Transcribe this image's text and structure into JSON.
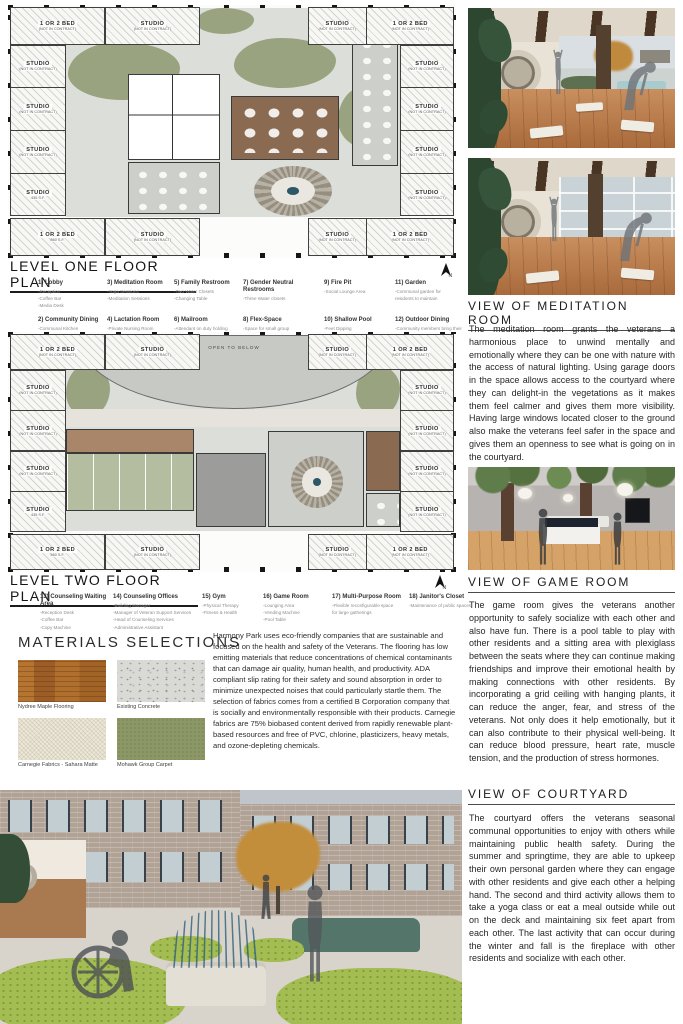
{
  "poster": {
    "north_label": "N",
    "units": {
      "top_left": [
        {
          "t": "1 OR 2 BED",
          "s": "(NOT IN CONTRACT)"
        },
        {
          "t": "STUDIO",
          "s": "(NOT IN CONTRACT)"
        }
      ],
      "top_right": [
        {
          "t": "STUDIO",
          "s": "(NOT IN CONTRACT)"
        },
        {
          "t": "1 OR 2 BED",
          "s": "(NOT IN CONTRACT)"
        }
      ],
      "left_col": [
        {
          "t": "STUDIO",
          "s": "(NOT IN CONTRACT)"
        },
        {
          "t": "STUDIO",
          "s": "(NOT IN CONTRACT)"
        },
        {
          "t": "STUDIO",
          "s": "(NOT IN CONTRACT)"
        },
        {
          "t": "STUDIO",
          "s": "435 S.F."
        }
      ],
      "right_col": [
        {
          "t": "STUDIO",
          "s": "(NOT IN CONTRACT)"
        },
        {
          "t": "STUDIO",
          "s": "(NOT IN CONTRACT)"
        },
        {
          "t": "STUDIO",
          "s": "(NOT IN CONTRACT)"
        },
        {
          "t": "STUDIO",
          "s": "(NOT IN CONTRACT)"
        }
      ],
      "bottom_left": [
        {
          "t": "1 OR 2 BED",
          "s": "860 S.F."
        },
        {
          "t": "STUDIO",
          "s": "(NOT IN CONTRACT)"
        }
      ],
      "bottom_right": [
        {
          "t": "STUDIO",
          "s": "(NOT IN CONTRACT)"
        },
        {
          "t": "1 OR 2 BED",
          "s": "(NOT IN CONTRACT)"
        }
      ]
    },
    "plan_one": {
      "title": "LEVEL ONE FLOOR PLAN",
      "legend": [
        {
          "label": "1) Lobby",
          "details": "-Reception\n-Coffee Bar\n-Media Desk"
        },
        {
          "label": "2) Community Dining",
          "details": "-Communal Kitchen\n-Dining Seating"
        },
        {
          "label": "3) Meditation Room",
          "details": "-Yoga Sessions\n-Meditation Sessions"
        },
        {
          "label": "4) Lactation Room",
          "details": "-Private Nursing Room"
        },
        {
          "label": "5) Family Restroom",
          "details": "-Two Water Closets\n-Changing Table"
        },
        {
          "label": "6) Mailroom",
          "details": "-Attendant on duty holding\nmail/packages"
        },
        {
          "label": "7) Gender Neutral Restrooms",
          "details": "-Three Water closets"
        },
        {
          "label": "8) Flex-Space",
          "details": "-Space for small group\ngatherings"
        },
        {
          "label": "9) Fire Pit",
          "details": "-Social Lounge Area"
        },
        {
          "label": "10) Shallow Pool",
          "details": "-Feet Dipping"
        },
        {
          "label": "11) Garden",
          "details": "-Communal garden for\nresidents to maintain"
        },
        {
          "label": "12) Outdoor Dining",
          "details": "-Community members bring their\nown meal to the space"
        }
      ]
    },
    "plan_two": {
      "title": "LEVEL TWO FLOOR PLAN",
      "open_to_below": "OPEN TO BELOW",
      "legend": [
        {
          "label": "13) Counseling Waiting Area",
          "details": "-Reception Desk\n-Coffee Bar\n-Copy Machine"
        },
        {
          "label": "14) Counseling Offices",
          "details": "-Building Manager\n-Manager of Veteran Support Services\n-Head of Counseling Services\n-Administrative Assistant"
        },
        {
          "label": "15) Gym",
          "details": "-Physical Therapy\n-Fitness & Health"
        },
        {
          "label": "16) Game Room",
          "details": "-Lounging Area\n-Vending Machine\n-Pool Table"
        },
        {
          "label": "17) Multi-Purpose Room",
          "details": "-Flexible reconfigurable space\nfor large gatherings"
        },
        {
          "label": "18) Janitor's Closet",
          "details": "-Maintenance of public spaces"
        }
      ]
    },
    "materials": {
      "title": "MATERIALS SELECTIONS",
      "items": [
        {
          "label": "Nydree Maple Flooring"
        },
        {
          "label": "Existing Concrete"
        },
        {
          "label": "Carnegie Fabrics - Sahara Matte"
        },
        {
          "label": "Mohawk Group Carpet"
        }
      ],
      "paragraph": "Harmony Park uses eco-friendly companies that are sustainable and focused on the health and safety of the Veterans. The flooring has low emitting materials that reduce concentrations of chemical contaminants that can damage air quality, human health, and productivity. ADA compliant slip rating for their safety and sound absorption in order to minimize unexpected noises that could particularly startle them. The selection of fabrics comes from a certified B Corporation company that is socially and environmentally responsible with their products. Carnegie fabrics are 75% biobased content derived from rapidly renewable plant-based resources and free of PVC, chlorine, plasticizers, heavy metals, and ozone-depleting chemicals."
    },
    "views": {
      "meditation": {
        "title": "VIEW OF MEDITATION ROOM",
        "body": "The meditation room grants the veterans a harmonious place to unwind mentally and emotionally where they can be one with nature with the access of natural lighting. Using garage doors in the space allows access to the courtyard where they can delight-in the vegetations as it makes them feel calmer and gives them more visibility. Having large windows located closer to the ground also make the veterans feel safer in the space and gives them an openness to see what is going on in the courtyard."
      },
      "game": {
        "title": "VIEW OF GAME ROOM",
        "body": "The game room gives the veterans another opportunity to safely socialize with each other and also have fun. There is a pool table to play with other residents and a sitting area with plexiglass between the seats where they can continue making friendships and improve their emotional health by making connections with other residents. By incorporating a grid ceiling with hanging plants, it can reduce the anger, fear, and stress of the veterans. Not only does it help emotionally, but it can also contribute to their physical well-being. It can reduce blood pressure, heart rate, muscle tension, and the production of stress hormones."
      },
      "courtyard": {
        "title": "VIEW OF COURTYARD",
        "body": "The courtyard offers the veterans seasonal communal opportunities to enjoy with others while maintaining public health safety. During the summer and springtime, they are able to upkeep their own personal garden where they can engage with other residents and give each other a helping hand. The second and third activity allows them to take a yoga class or eat a meal outside while out on the deck and maintaining six feet apart from each other. The last activity that can occur during the winter and fall is the fireplace with other residents and socialize with each other."
      }
    },
    "colors": {
      "plan_landscape_green": "#9aa37f",
      "plan_wood_floor": "#8a6a50",
      "material_wood": "#a9682f",
      "material_concrete": "#d9d9d5",
      "material_fabric": "#ece8da",
      "material_carpet": "#8b9765",
      "hedge_green": "#a3bd52",
      "pool_teal": "#54756a"
    }
  }
}
